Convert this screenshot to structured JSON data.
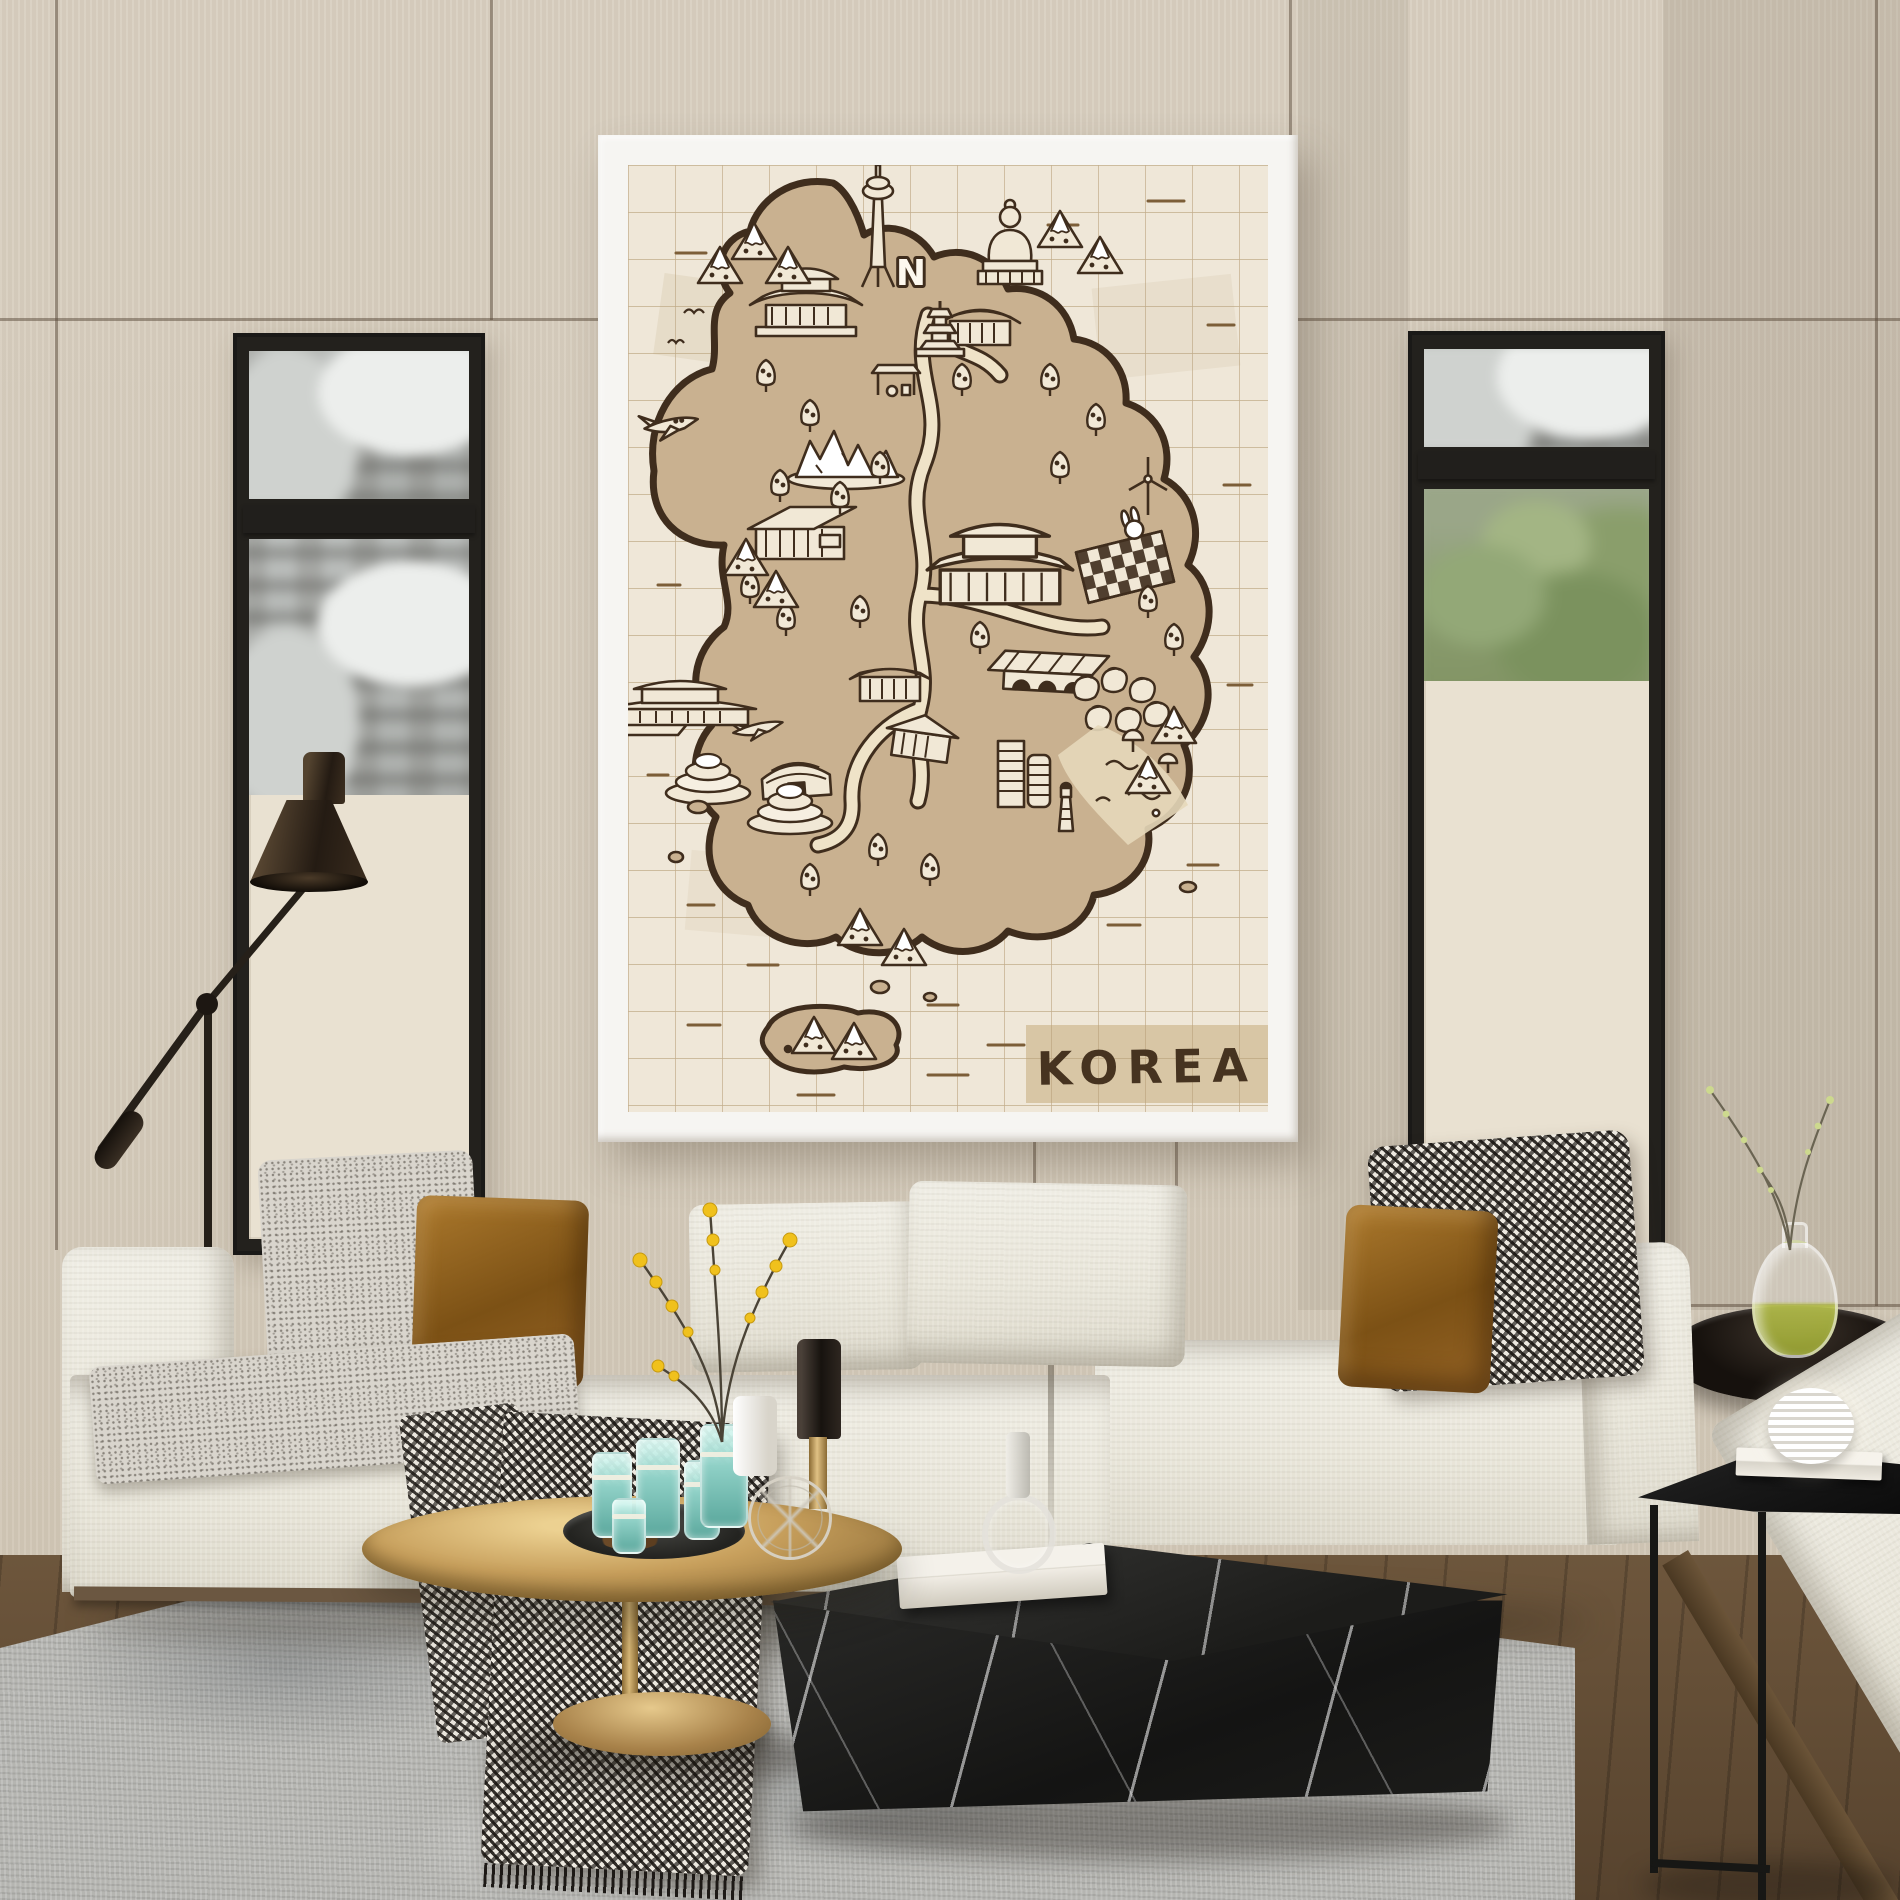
{
  "poster": {
    "title": "KOREA",
    "compass_label": "N",
    "frame_color": "#f6f5f2",
    "paper_color": "#efe7d8",
    "grid_color": "#b79f78",
    "land_color": "#c9b190",
    "ink_color": "#3f2d1d",
    "road_color": "#efe3c8",
    "label_band_color": "#d6c4a2",
    "landmarks": [
      "n-seoul-tower",
      "buddha-statue",
      "palace",
      "pagoda",
      "hanok-house",
      "shrine-hut",
      "rocky-crag",
      "mountains",
      "trees",
      "airplane",
      "fighter-jet",
      "ferry-boat",
      "farm-house",
      "country-house",
      "tilted-house",
      "barn",
      "greenhouse",
      "onggi-jars",
      "checkerboard-with-rabbit",
      "wind-turbine",
      "modern-buildings",
      "lighthouse",
      "rice-terraces",
      "beach-with-waves",
      "jeju-island",
      "sea-birds"
    ]
  },
  "room": {
    "wall_color": "#d7cec0",
    "seam_color": "#5a4a3a",
    "floor_color": "#5f4a33",
    "rug_color": "#b5b5b1",
    "window_frame_color": "#23211d",
    "left_window_view": "blurred gray brick house",
    "right_window_view": "blurred green foliage",
    "privacy_panel_color": "#e9e1d1",
    "lamp_color": "#28211b",
    "sofa_fabric_color": "#ebe8de",
    "pillow_colors": {
      "speckled_gray": "#d8d4cc",
      "velvet_brown": "#8c5c1e",
      "linen_white": "#eeebe1",
      "houndstooth": "#1a1713"
    },
    "throw_pattern": "houndstooth",
    "brass_table_color": "#c79f5c",
    "tray_color": "#33322f",
    "glass_jar_color": "#8fd0c6",
    "flower_color": "#f0c11c",
    "marble_table_color": "#171717",
    "book_color": "#f2efe8",
    "side_table_color": "#111111",
    "sphere_lamp_color": "#f5f3ee",
    "vase_liquid_color": "#b8c24d",
    "ottoman_color": "#f3f1ea",
    "wood_base_color": "#5a4530"
  }
}
